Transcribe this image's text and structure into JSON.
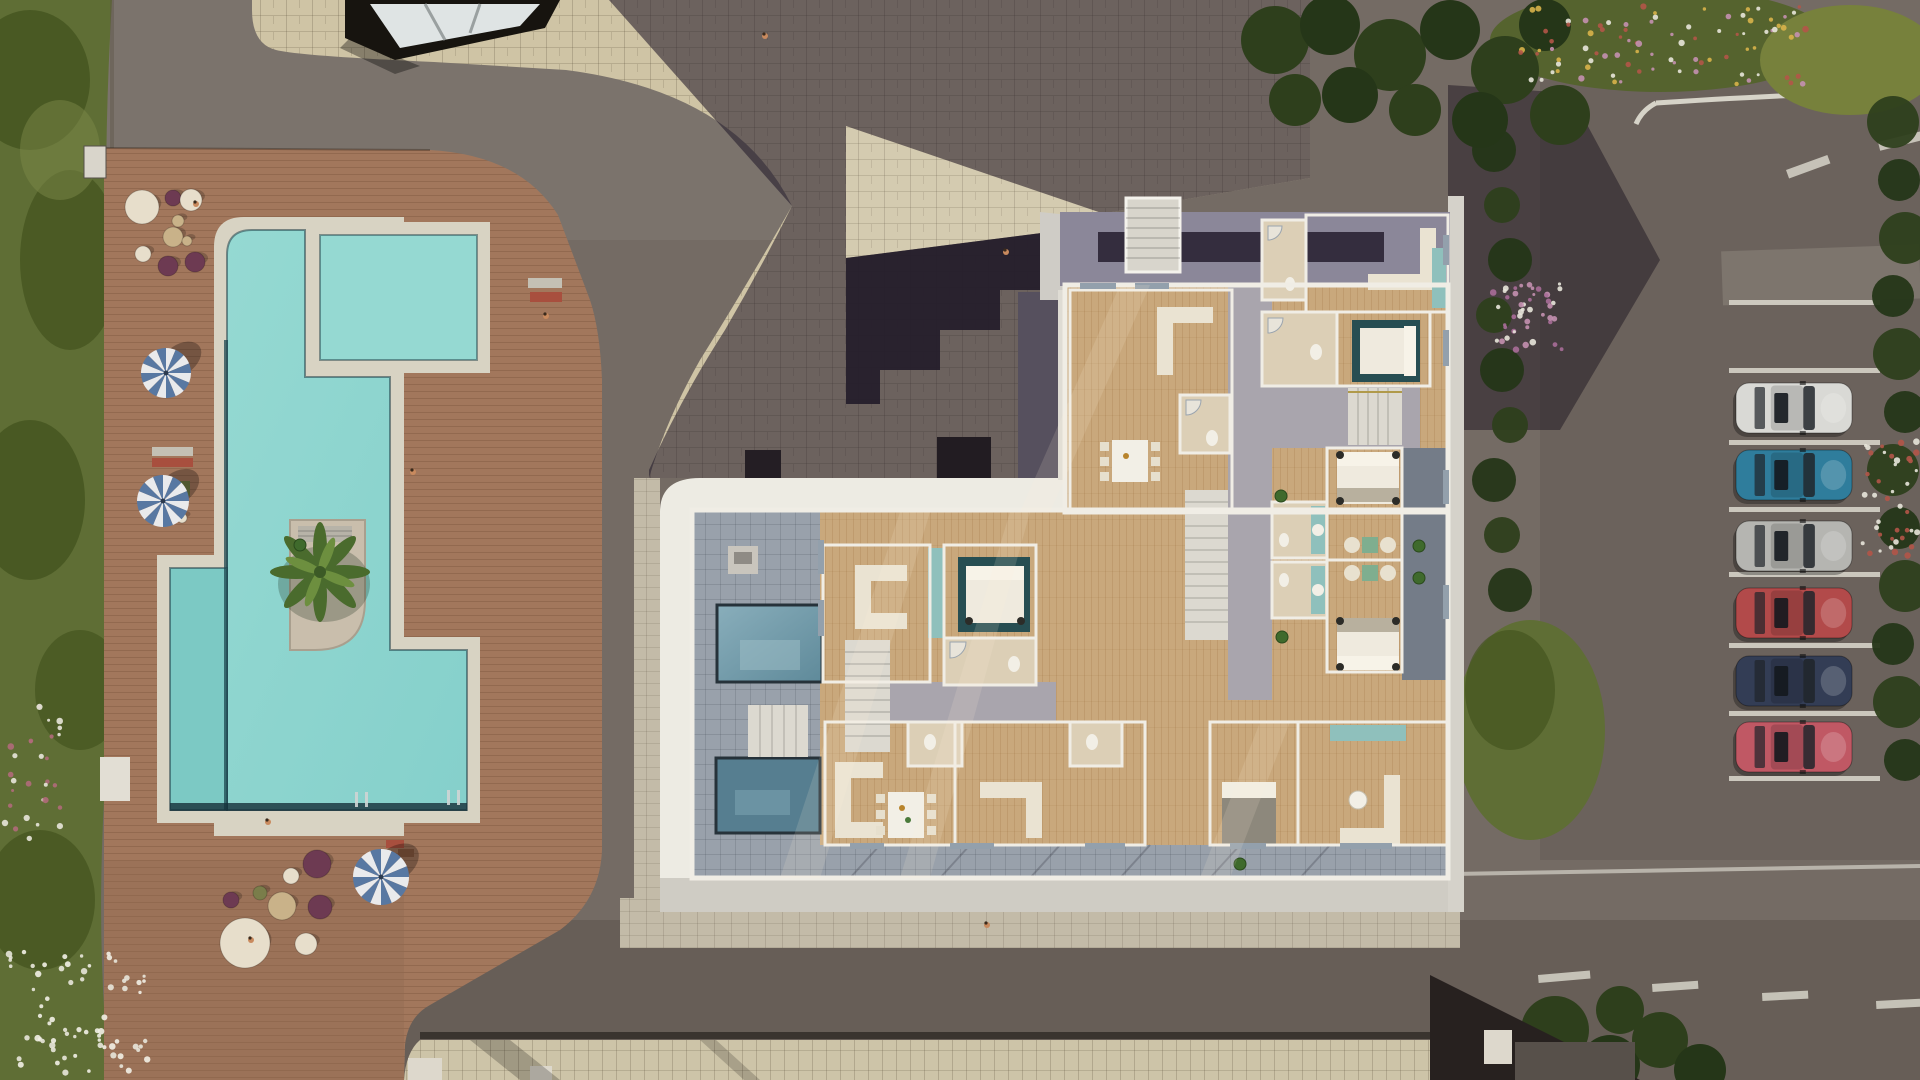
{
  "palette": {
    "asphalt": "#746b64",
    "asphalt_light": "#7b736c",
    "road_dark": "#675e57",
    "paver": "#cfc4a5",
    "paver_lit": "#d8cdab",
    "deck": "#a2775c",
    "deck_dark": "#8f6a50",
    "grass": "#5f6e35",
    "grass_dark": "#44541f",
    "bush": "#2e3f1c",
    "tree": "#253618",
    "water": "#85d0cb",
    "water_light": "#95d9d2",
    "water_arm": "#7cc9c4",
    "water_dark": "#15303a",
    "pool_border": "#d8d3c3",
    "island": "#c9beac",
    "palm": "#4a6b2d",
    "palm_light": "#6d8f3f",
    "shadow": "#241b2b",
    "roof_band": "#8b8799",
    "roof_inset": "#342d3e",
    "fascia": "#edebe3",
    "fascia_dim": "#cfccc4",
    "tile": "#99a1ab",
    "tile_dark": "#747c88",
    "corridor": "#a9a5ad",
    "wood": "#c9a87c",
    "wall": "#f0ede5",
    "bath": "#dccfb6",
    "sofa": "#eae3d2",
    "bed_white": "#efeade",
    "bed_gray": "#8d887c",
    "teal": "#8fc0bc",
    "teal_dark": "#274e52",
    "stair": "#dcd9d0",
    "window_frame": "#93a0ac",
    "white_line": "#d6d3c8",
    "umbrella_blue": "#5878a2",
    "umbrella_white": "#e9eaec",
    "pouf_purple": "#6d3a52",
    "pouf_cream": "#e7decb",
    "pouf_tan": "#c9b289",
    "pouf_green": "#7a7d4a",
    "skin": "#c98a5e"
  },
  "site": {
    "pool": {
      "lane_line": "#1d4750",
      "ladders": [
        [
          447,
          790
        ],
        [
          355,
          792
        ]
      ],
      "palm": {
        "cx": 320,
        "cy": 572
      }
    },
    "deck": {
      "umbrellas": [
        [
          166,
          373,
          25
        ],
        [
          163,
          501,
          26
        ],
        [
          381,
          877,
          28
        ]
      ],
      "poufs": [
        [
          142,
          207,
          17,
          "pouf_cream"
        ],
        [
          173,
          198,
          8,
          "pouf_purple"
        ],
        [
          191,
          200,
          11,
          "pouf_cream"
        ],
        [
          178,
          221,
          6,
          "pouf_tan"
        ],
        [
          173,
          237,
          10,
          "pouf_tan"
        ],
        [
          187,
          241,
          5,
          "pouf_tan"
        ],
        [
          143,
          254,
          8,
          "pouf_cream"
        ],
        [
          168,
          266,
          10,
          "pouf_purple"
        ],
        [
          195,
          262,
          10,
          "pouf_purple"
        ],
        [
          182,
          518,
          5,
          "pouf_cream"
        ],
        [
          317,
          864,
          14,
          "pouf_purple"
        ],
        [
          291,
          876,
          8,
          "pouf_cream"
        ],
        [
          282,
          906,
          14,
          "pouf_tan"
        ],
        [
          260,
          893,
          7,
          "pouf_green"
        ],
        [
          231,
          900,
          8,
          "pouf_purple"
        ],
        [
          245,
          943,
          25,
          "pouf_cream"
        ],
        [
          306,
          944,
          11,
          "pouf_cream"
        ],
        [
          320,
          907,
          12,
          "pouf_purple"
        ]
      ],
      "loungers": [
        [
          152,
          447,
          41,
          9,
          "#c4c0b4",
          0
        ],
        [
          152,
          458,
          41,
          9,
          "#a84f3e",
          0
        ],
        [
          176,
          481,
          14,
          15,
          "#6f7a42",
          0
        ],
        [
          528,
          278,
          34,
          10,
          "#c4c0b4",
          0
        ],
        [
          530,
          292,
          32,
          10,
          "#a84f3e",
          0
        ],
        [
          386,
          840,
          18,
          8,
          "#a84f3e",
          0
        ],
        [
          398,
          849,
          16,
          8,
          "#8a5a40",
          0
        ]
      ]
    },
    "parking": {
      "stall_lines_y": [
        300,
        368,
        440,
        507,
        572,
        643,
        711,
        776
      ],
      "line_x": 1729,
      "line_w": 151,
      "cars": [
        [
          383,
          "white",
          "#d9d9d5"
        ],
        [
          450,
          "teal-blue",
          "#2f7d9c"
        ],
        [
          521,
          "silver",
          "#b5b5b1"
        ],
        [
          588,
          "red",
          "#b24a4a"
        ],
        [
          656,
          "navy",
          "#333d55"
        ],
        [
          722,
          "pink-red",
          "#c05864"
        ]
      ]
    },
    "people": [
      [
        765,
        36
      ],
      [
        1006,
        252
      ],
      [
        546,
        316
      ],
      [
        413,
        472
      ],
      [
        268,
        822
      ],
      [
        987,
        925
      ],
      [
        196,
        204
      ],
      [
        251,
        940
      ]
    ],
    "plants": [
      [
        1281,
        496
      ],
      [
        1282,
        637
      ],
      [
        1419,
        546
      ],
      [
        1419,
        578
      ],
      [
        1240,
        864
      ],
      [
        300,
        545
      ]
    ],
    "road_dashes": [
      [
        1538,
        975,
        52,
        8,
        -5
      ],
      [
        1652,
        984,
        46,
        8,
        -4
      ],
      [
        1762,
        993,
        46,
        8,
        -3
      ],
      [
        1876,
        1001,
        44,
        8,
        -3
      ],
      [
        1786,
        170,
        44,
        9,
        -20
      ],
      [
        1878,
        142,
        44,
        9,
        -14
      ]
    ],
    "trees": {
      "right_edge": {
        "x": 1899,
        "y0": 122,
        "y1": 800,
        "step": 58,
        "r": 26
      },
      "hedge_mid": {
        "x": 1502,
        "y0": 150,
        "y1": 620,
        "step": 55,
        "r": 22
      },
      "top_right": [
        [
          1275,
          40,
          34
        ],
        [
          1330,
          25,
          30
        ],
        [
          1390,
          55,
          36
        ],
        [
          1450,
          30,
          30
        ],
        [
          1505,
          70,
          34
        ],
        [
          1545,
          25,
          26
        ],
        [
          1560,
          115,
          30
        ],
        [
          1480,
          120,
          28
        ],
        [
          1415,
          110,
          26
        ],
        [
          1350,
          95,
          28
        ],
        [
          1295,
          100,
          26
        ]
      ],
      "bottom_right": [
        [
          1555,
          1030,
          34
        ],
        [
          1610,
          1065,
          30
        ],
        [
          1660,
          1040,
          28
        ],
        [
          1700,
          1070,
          26
        ],
        [
          1620,
          1010,
          24
        ],
        [
          1480,
          1056,
          22
        ]
      ]
    },
    "flowers": [
      [
        1520,
        4,
        1808,
        84,
        90,
        [
          "#e8e6da",
          "#b35548",
          "#c490b0",
          "#d8b24a"
        ],
        7
      ],
      [
        8,
        952,
        150,
        1075,
        70,
        [
          "#e8e6da",
          "#f2f0e6"
        ],
        11
      ],
      [
        5,
        700,
        60,
        860,
        30,
        [
          "#b06a7a",
          "#e8e6da"
        ],
        23
      ],
      [
        1490,
        284,
        1562,
        352,
        45,
        [
          "#c490b0",
          "#a86d98",
          "#e8e6da"
        ],
        31
      ],
      [
        1862,
        440,
        1918,
        556,
        40,
        [
          "#b35548",
          "#e8e6da"
        ],
        41
      ]
    ]
  }
}
